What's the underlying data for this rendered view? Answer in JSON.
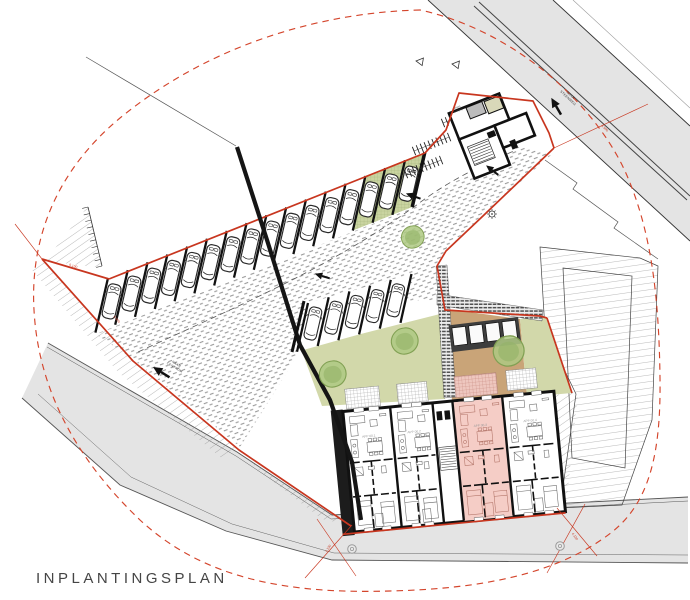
{
  "title": "INPLANTINGSPLAN",
  "colors": {
    "boundary_red": "#c8361f",
    "dashed_red": "#d4452c",
    "road_gray": "#e4e4e4",
    "garden_green": "#d2d8aa",
    "garden_brown": "#c9a478",
    "green_parking": "#c9d4a0",
    "unit_pink": "#f5cdc6",
    "terrace_pink": "#e9bab0",
    "tree_fill": "#aec983",
    "tree_edge": "#81a053",
    "beige_room": "#d9d8b9",
    "gray_room": "#bcbcbc",
    "shed_dark": "#3d3d3d"
  },
  "plan": {
    "roads": {
      "top": {
        "label_lines": [
          "NAAR",
          "STEENWEG"
        ]
      },
      "bottom": {
        "label_lines": [
          "NAAR",
          "CENTRUM"
        ]
      }
    },
    "parking": {
      "row1": {
        "standard_spots": 13,
        "green_spots": 3,
        "cars": 16
      },
      "row2": {
        "spots": 5,
        "cars": 5
      },
      "bike_rack_rows": 3,
      "garden_sheds": 4
    },
    "trees": 4,
    "manholes": 2,
    "drive_arrows": 3,
    "units": [
      {
        "label": "APP 00.1",
        "highlighted": false
      },
      {
        "label": "APP 00.2",
        "highlighted": false
      },
      {
        "label": "APP 00.3",
        "highlighted": true
      },
      {
        "label": "APP 00.4",
        "highlighted": false
      }
    ],
    "entrance_room_labels": [
      "fietsen",
      "berging"
    ],
    "dimensions": [
      "5.100",
      "3.500",
      "4.130",
      "4.130",
      "8.500"
    ]
  }
}
